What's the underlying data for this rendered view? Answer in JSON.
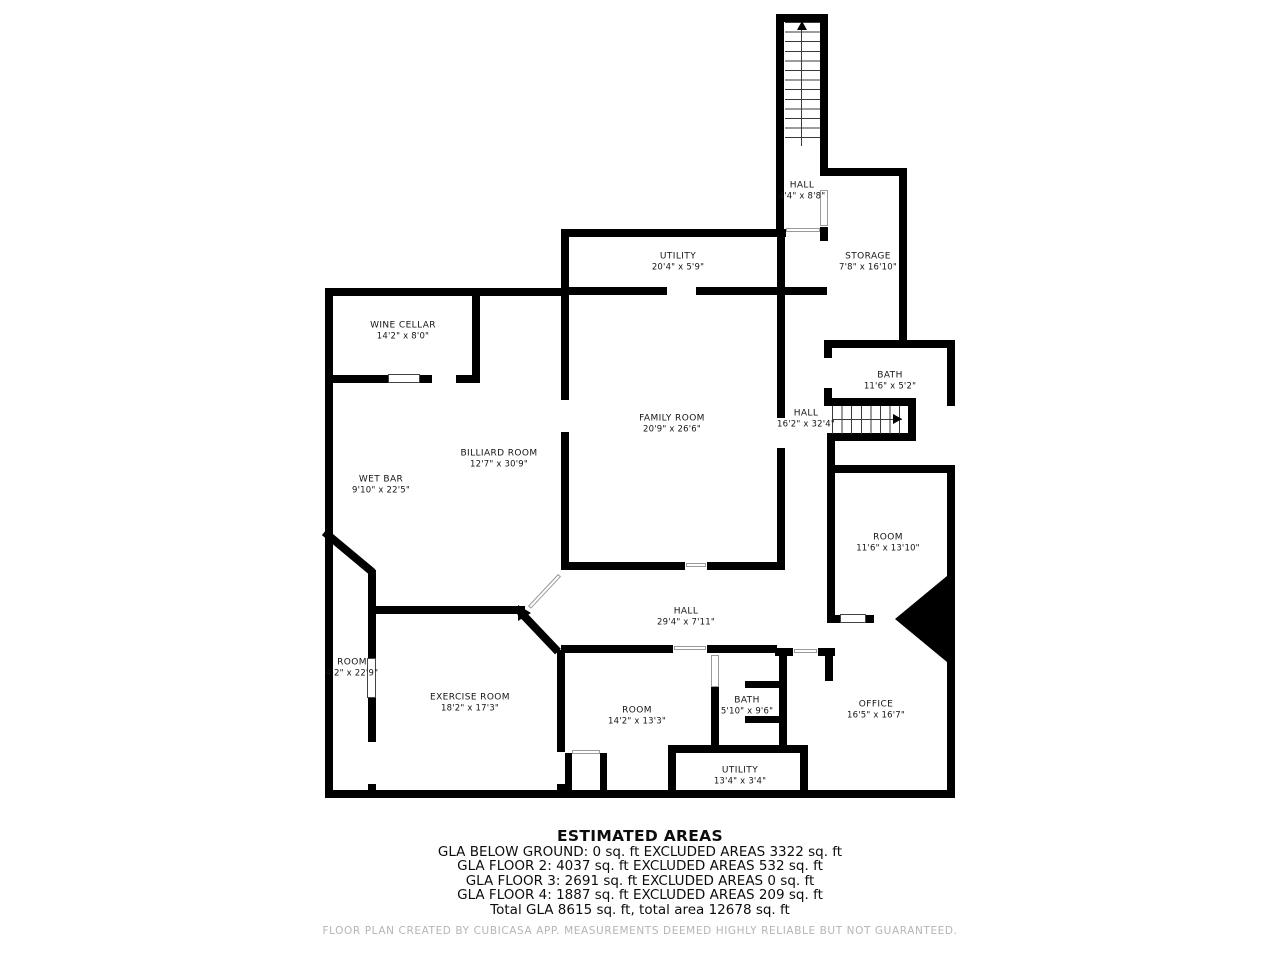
{
  "plan": {
    "rooms": [
      {
        "name": "HALL",
        "dims": "4'4\" x 8'8\""
      },
      {
        "name": "STORAGE",
        "dims": "7'8\" x 16'10\""
      },
      {
        "name": "UTILITY",
        "dims": "20'4\" x 5'9\""
      },
      {
        "name": "WINE CELLAR",
        "dims": "14'2\" x 8'0\""
      },
      {
        "name": "FAMILY ROOM",
        "dims": "20'9\" x 26'6\""
      },
      {
        "name": "BATH",
        "dims": "11'6\" x 5'2\""
      },
      {
        "name": "HALL",
        "dims": "16'2\" x 32'4\""
      },
      {
        "name": "BILLIARD ROOM",
        "dims": "12'7\" x 30'9\""
      },
      {
        "name": "WET BAR",
        "dims": "9'10\" x 22'5\""
      },
      {
        "name": "ROOM",
        "dims": "11'6\" x 13'10\""
      },
      {
        "name": "HALL",
        "dims": "29'4\" x 7'11\""
      },
      {
        "name": "ROOM",
        "dims": "4'2\" x 22'9\""
      },
      {
        "name": "EXERCISE ROOM",
        "dims": "18'2\" x 17'3\""
      },
      {
        "name": "ROOM",
        "dims": "14'2\" x 13'3\""
      },
      {
        "name": "BATH",
        "dims": "5'10\" x 9'6\""
      },
      {
        "name": "OFFICE",
        "dims": "16'5\" x 16'7\""
      },
      {
        "name": "UTILITY",
        "dims": "13'4\" x 3'4\""
      }
    ]
  },
  "estimated_areas": {
    "title": "ESTIMATED AREAS",
    "lines": [
      "GLA BELOW GROUND: 0 sq. ft EXCLUDED AREAS 3322 sq. ft",
      "GLA FLOOR 2: 4037 sq. ft EXCLUDED AREAS 532 sq. ft",
      "GLA FLOOR 3: 2691 sq. ft EXCLUDED AREAS 0 sq. ft",
      "GLA FLOOR 4: 1887 sq. ft EXCLUDED AREAS 209 sq. ft",
      "Total GLA 8615 sq. ft, total area 12678 sq. ft"
    ]
  },
  "footer": "FLOOR PLAN CREATED BY CUBICASA APP. MEASUREMENTS DEEMED HIGHLY RELIABLE BUT NOT GUARANTEED.",
  "colors": {
    "wall": "#000000",
    "credit_text": "#b5b5b5"
  }
}
